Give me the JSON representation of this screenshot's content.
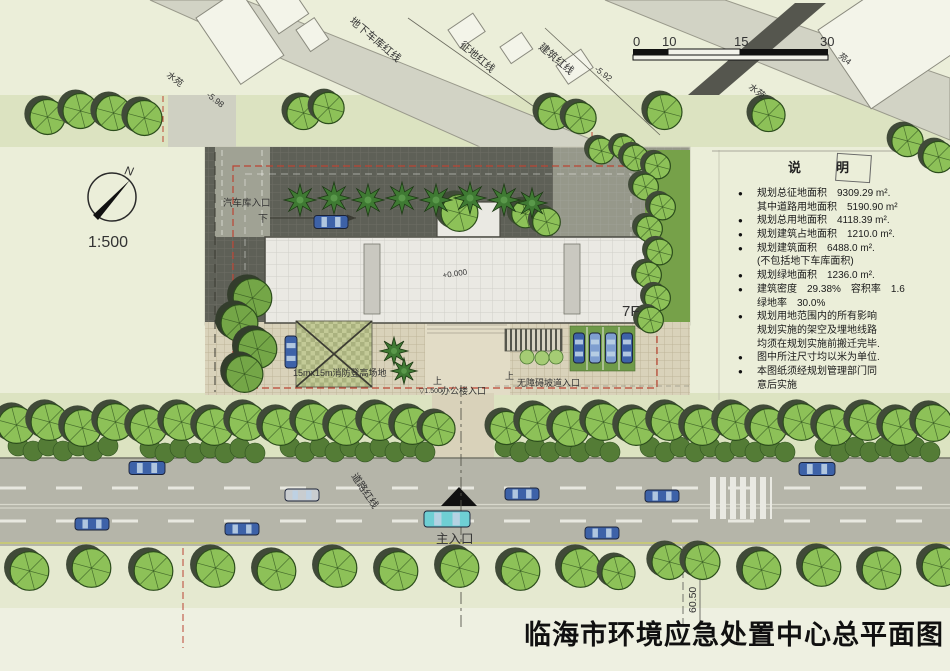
{
  "title": "临海市环境应急处置中心总平面图",
  "compass": {
    "north": "N",
    "scale": "1:500"
  },
  "scale_bar": {
    "ticks": [
      "0",
      "10",
      "15",
      "30"
    ]
  },
  "legend": {
    "title": "说　明",
    "items": [
      {
        "bullet": true,
        "text": "规划总征地面积　9309.29 m²."
      },
      {
        "bullet": false,
        "text": "其中道路用地面积　5190.90 m²"
      },
      {
        "bullet": true,
        "text": "规划总用地面积　4118.39 m²."
      },
      {
        "bullet": true,
        "text": "规划建筑占地面积　1210.0 m²."
      },
      {
        "bullet": true,
        "text": "规划建筑面积　6488.0 m²."
      },
      {
        "bullet": false,
        "text": "(不包括地下车库面积)"
      },
      {
        "bullet": true,
        "text": "规划绿地面积　1236.0 m²."
      },
      {
        "bullet": true,
        "text": "建筑密度　29.38%　容积率　1.6"
      },
      {
        "bullet": false,
        "text": "绿地率　30.0%"
      },
      {
        "bullet": true,
        "text": "规划用地范围内的所有影响"
      },
      {
        "bullet": false,
        "text": "规划实施的架空及埋地线路"
      },
      {
        "bullet": false,
        "text": "均须在规划实施前搬迁完毕."
      },
      {
        "bullet": true,
        "text": "图中所注尺寸均以米为单位."
      },
      {
        "bullet": true,
        "text": "本图纸须经规划管理部门同"
      },
      {
        "bullet": false,
        "text": "意后实施"
      }
    ]
  },
  "labels": {
    "redline_garage": "地下车库红线",
    "redline_land": "征地红线",
    "redline_building": "建筑红线",
    "redline_road": "道路红线",
    "water_garden_left": "水苑",
    "water_garden_right": "水苑",
    "block_right": "苑4",
    "spot_left": "-5.98",
    "spot_right": "-5.92",
    "garage_entrance": "汽车库入口",
    "down": "下",
    "up_office": "上",
    "up_ramp": "上",
    "building_floors": "7F",
    "level_main": "+0.000",
    "level_entrance": "▽1.500",
    "office_entrance": "办公楼入口",
    "ramp_entrance": "无障碍坡道入口",
    "fire_pad": "15mx15m消防登高场地",
    "main_entrance": "主入口",
    "road_dim": "60.50"
  },
  "plan": {
    "colors": {
      "blue": "#3d62a8",
      "lightblue": "#7f9fd0",
      "silver": "#c9cdd0",
      "cyan": "#6fcfd4",
      "tree_fill": "#8dc158",
      "tree_stroke": "#2c4d1c",
      "tree_dark_fill": "#74a647",
      "palm_fill": "#3f7a33",
      "hedge_fill": "#547c36",
      "bush_fill": "#a5cc74",
      "redline": "#bb4433"
    },
    "trees_round": [
      [
        46,
        116,
        19
      ],
      [
        79,
        110,
        19
      ],
      [
        112,
        112,
        19
      ],
      [
        143,
        117,
        19
      ],
      [
        302,
        112,
        18
      ],
      [
        327,
        107,
        17
      ],
      [
        553,
        112,
        18
      ],
      [
        579,
        117,
        17
      ],
      [
        663,
        111,
        19
      ],
      [
        767,
        114,
        18
      ],
      [
        906,
        140,
        17
      ],
      [
        937,
        156,
        17
      ],
      [
        600,
        150,
        14
      ],
      [
        623,
        147,
        13
      ],
      [
        634,
        157,
        14
      ],
      [
        656,
        165,
        14
      ],
      [
        644,
        186,
        14
      ],
      [
        661,
        206,
        14
      ],
      [
        648,
        228,
        14
      ],
      [
        658,
        251,
        14
      ],
      [
        647,
        274,
        14
      ],
      [
        656,
        297,
        14
      ],
      [
        649,
        319,
        14
      ],
      [
        458,
        212,
        20
      ],
      [
        524,
        213,
        15
      ],
      [
        545,
        221,
        15
      ],
      [
        15,
        424,
        20
      ],
      [
        48,
        421,
        20
      ],
      [
        81,
        427,
        20
      ],
      [
        114,
        421,
        20
      ],
      [
        147,
        426,
        20
      ],
      [
        180,
        421,
        20
      ],
      [
        213,
        426,
        20
      ],
      [
        246,
        421,
        20
      ],
      [
        279,
        426,
        20
      ],
      [
        312,
        421,
        20
      ],
      [
        345,
        426,
        20
      ],
      [
        378,
        421,
        20
      ],
      [
        411,
        425,
        20
      ],
      [
        437,
        428,
        18
      ],
      [
        505,
        427,
        18
      ],
      [
        536,
        422,
        20
      ],
      [
        569,
        427,
        20
      ],
      [
        602,
        421,
        20
      ],
      [
        635,
        426,
        20
      ],
      [
        668,
        421,
        20
      ],
      [
        701,
        426,
        20
      ],
      [
        734,
        421,
        20
      ],
      [
        767,
        426,
        20
      ],
      [
        800,
        421,
        20
      ],
      [
        833,
        426,
        20
      ],
      [
        866,
        421,
        20
      ],
      [
        899,
        426,
        20
      ],
      [
        932,
        422,
        20
      ],
      [
        28,
        570,
        21
      ],
      [
        90,
        567,
        21
      ],
      [
        152,
        570,
        21
      ],
      [
        214,
        567,
        21
      ],
      [
        275,
        570,
        21
      ],
      [
        336,
        567,
        21
      ],
      [
        397,
        570,
        21
      ],
      [
        458,
        567,
        21
      ],
      [
        519,
        570,
        21
      ],
      [
        579,
        567,
        21
      ],
      [
        617,
        572,
        18
      ],
      [
        668,
        561,
        19
      ],
      [
        701,
        561,
        19
      ],
      [
        760,
        569,
        21
      ],
      [
        820,
        566,
        21
      ],
      [
        880,
        569,
        21
      ],
      [
        940,
        566,
        21
      ]
    ],
    "trees_dark": [
      [
        251,
        297,
        21
      ],
      [
        238,
        322,
        20
      ],
      [
        256,
        348,
        21
      ],
      [
        243,
        373,
        20
      ]
    ],
    "palms": [
      [
        300,
        200,
        16
      ],
      [
        334,
        198,
        16
      ],
      [
        368,
        200,
        16
      ],
      [
        402,
        198,
        16
      ],
      [
        436,
        200,
        16
      ],
      [
        470,
        198,
        16
      ],
      [
        504,
        200,
        16
      ],
      [
        532,
        203,
        15
      ],
      [
        394,
        351,
        14
      ],
      [
        404,
        371,
        13
      ]
    ],
    "bushes": [
      [
        527,
        357,
        7
      ],
      [
        542,
        358,
        7
      ],
      [
        556,
        357,
        7
      ]
    ],
    "hedges": [
      [
        18,
        120,
        448
      ],
      [
        150,
        255,
        450
      ],
      [
        290,
        430,
        449
      ],
      [
        505,
        615,
        449
      ],
      [
        650,
        790,
        449
      ],
      [
        825,
        935,
        449
      ]
    ],
    "cars": [
      {
        "x": 331,
        "y": 222,
        "w": 34,
        "h": 13,
        "rot": 0,
        "color": "blue"
      },
      {
        "x": 291,
        "y": 352,
        "w": 32,
        "h": 12,
        "rot": 90,
        "color": "blue"
      },
      {
        "x": 579,
        "y": 348,
        "w": 30,
        "h": 11,
        "rot": 90,
        "color": "blue"
      },
      {
        "x": 595,
        "y": 348,
        "w": 30,
        "h": 11,
        "rot": 90,
        "color": "lightblue"
      },
      {
        "x": 611,
        "y": 348,
        "w": 30,
        "h": 11,
        "rot": 90,
        "color": "lightblue"
      },
      {
        "x": 627,
        "y": 348,
        "w": 30,
        "h": 11,
        "rot": 90,
        "color": "blue"
      },
      {
        "x": 147,
        "y": 468,
        "w": 36,
        "h": 13,
        "rot": 0,
        "color": "blue"
      },
      {
        "x": 817,
        "y": 469,
        "w": 36,
        "h": 13,
        "rot": 0,
        "color": "blue"
      },
      {
        "x": 302,
        "y": 495,
        "w": 34,
        "h": 12,
        "rot": 0,
        "color": "silver"
      },
      {
        "x": 522,
        "y": 494,
        "w": 34,
        "h": 12,
        "rot": 0,
        "color": "blue"
      },
      {
        "x": 662,
        "y": 496,
        "w": 34,
        "h": 12,
        "rot": 0,
        "color": "blue"
      },
      {
        "x": 447,
        "y": 519,
        "w": 46,
        "h": 16,
        "rot": 0,
        "color": "cyan"
      },
      {
        "x": 92,
        "y": 524,
        "w": 34,
        "h": 12,
        "rot": 0,
        "color": "blue"
      },
      {
        "x": 242,
        "y": 529,
        "w": 34,
        "h": 12,
        "rot": 0,
        "color": "blue"
      },
      {
        "x": 602,
        "y": 533,
        "w": 34,
        "h": 12,
        "rot": 0,
        "color": "blue"
      }
    ]
  }
}
